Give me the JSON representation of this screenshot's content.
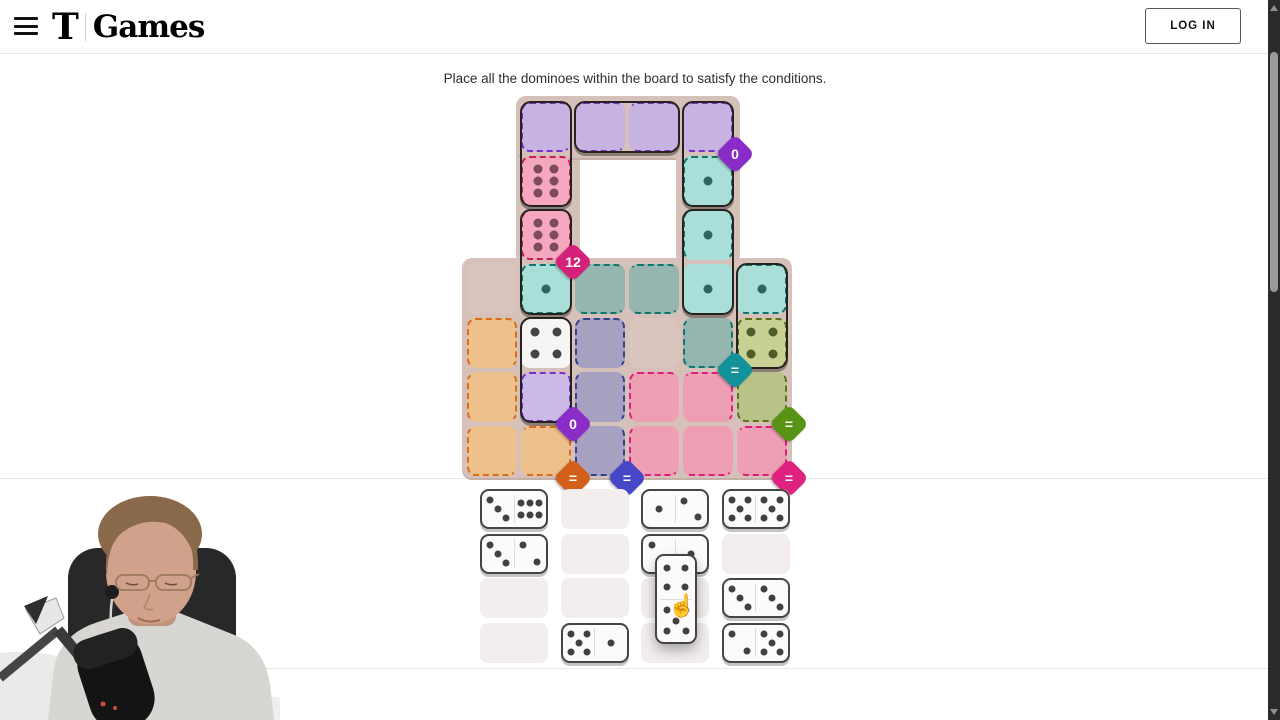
{
  "header": {
    "logo_t": "T",
    "logo_text": "Games",
    "login_label": "LOG IN"
  },
  "instruction": "Place all the dominoes within the board to satisfy the conditions.",
  "board": {
    "origin_x": 465,
    "origin_y": 100,
    "cell": 54,
    "plates": [
      {
        "x": 516,
        "y": 96,
        "w": 64,
        "h": 166
      },
      {
        "x": 516,
        "y": 96,
        "w": 224,
        "h": 62
      },
      {
        "x": 676,
        "y": 96,
        "w": 64,
        "h": 166
      },
      {
        "x": 462,
        "y": 258,
        "w": 330,
        "h": 220
      }
    ],
    "regions": {
      "purple": {
        "fill": "#c6b3e1",
        "empty": "#c6b3e1",
        "dash": "#7b2fc1",
        "pip": "#584a72"
      },
      "pink12": {
        "fill": "#f4a7bd",
        "empty": "#f4a7bd",
        "dash": "#c21f5e",
        "pip": "#7c4a61"
      },
      "teal": {
        "fill": "#a9ded9",
        "empty": "#95b6af",
        "dash": "#11756c",
        "pip": "#2f645f"
      },
      "olive": {
        "fill": "#c8d093",
        "empty": "#b8c388",
        "dash": "#5e7020",
        "pip": "#4e5c29"
      },
      "orange": {
        "fill": "#edc08c",
        "empty": "#edc08c",
        "dash": "#da6d18",
        "pip": "#8a5a20"
      },
      "slate": {
        "fill": "#a7a1c1",
        "empty": "#a7a1c1",
        "dash": "#33418f",
        "pip": "#3a3a5a"
      },
      "pinkB": {
        "fill": "#ef9fb3",
        "empty": "#ef9fb3",
        "dash": "#e11d7b",
        "pip": "#8a3a58"
      },
      "lavender": {
        "fill": "#cbb9e7",
        "empty": "#cbb9e7",
        "dash": "#7b2fc1",
        "pip": "#584a72"
      },
      "neutral": {
        "fill": "#d9c5bd",
        "empty": "#d9c5bd",
        "dash": null,
        "pip": "#444444"
      },
      "plain": {
        "fill": "#f7f5f4",
        "empty": "#f7f5f4",
        "dash": null,
        "pip": "#454545"
      }
    },
    "cells": [
      [
        0,
        1,
        "purple",
        0
      ],
      [
        0,
        2,
        "purple",
        0
      ],
      [
        0,
        3,
        "purple",
        0
      ],
      [
        0,
        4,
        "purple",
        0
      ],
      [
        1,
        1,
        "pink12",
        6
      ],
      [
        1,
        4,
        "teal",
        1
      ],
      [
        2,
        1,
        "pink12",
        6
      ],
      [
        2,
        4,
        "teal",
        1
      ],
      [
        3,
        0,
        "neutral",
        null
      ],
      [
        3,
        1,
        "teal",
        1
      ],
      [
        3,
        2,
        "teal",
        null
      ],
      [
        3,
        3,
        "teal",
        null
      ],
      [
        3,
        4,
        "teal",
        1
      ],
      [
        3,
        5,
        "teal",
        1
      ],
      [
        4,
        0,
        "orange",
        null
      ],
      [
        4,
        1,
        "plain",
        4
      ],
      [
        4,
        2,
        "slate",
        null
      ],
      [
        4,
        3,
        "neutral",
        null
      ],
      [
        4,
        4,
        "teal",
        null
      ],
      [
        4,
        5,
        "olive",
        4
      ],
      [
        5,
        0,
        "orange",
        null
      ],
      [
        5,
        1,
        "lavender",
        0
      ],
      [
        5,
        2,
        "slate",
        null
      ],
      [
        5,
        3,
        "pinkB",
        null
      ],
      [
        5,
        4,
        "pinkB",
        null
      ],
      [
        5,
        5,
        "olive",
        null
      ],
      [
        6,
        0,
        "orange",
        null
      ],
      [
        6,
        1,
        "orange",
        null
      ],
      [
        6,
        2,
        "slate",
        null
      ],
      [
        6,
        3,
        "pinkB",
        null
      ],
      [
        6,
        4,
        "pinkB",
        null
      ],
      [
        6,
        5,
        "pinkB",
        null
      ]
    ],
    "dominoes": [
      [
        0,
        1,
        1,
        1
      ],
      [
        0,
        2,
        0,
        3
      ],
      [
        0,
        4,
        1,
        4
      ],
      [
        2,
        1,
        3,
        1
      ],
      [
        2,
        4,
        3,
        4
      ],
      [
        3,
        5,
        4,
        5
      ],
      [
        4,
        1,
        5,
        1
      ]
    ],
    "badges": [
      {
        "label": "0",
        "color": "#8a2dc8",
        "col": 5,
        "row": 1
      },
      {
        "label": "12",
        "color": "#d4217a",
        "col": 2,
        "row": 3
      },
      {
        "label": "=",
        "color": "#13929b",
        "col": 5,
        "row": 5
      },
      {
        "label": "=",
        "color": "#579413",
        "col": 6,
        "row": 6
      },
      {
        "label": "0",
        "color": "#8a2dc8",
        "col": 2,
        "row": 6
      },
      {
        "label": "=",
        "color": "#d2601b",
        "col": 2,
        "row": 7
      },
      {
        "label": "=",
        "color": "#4547c6",
        "col": 3,
        "row": 7
      },
      {
        "label": "=",
        "color": "#df2280",
        "col": 6,
        "row": 7
      }
    ]
  },
  "tray": {
    "x0": 480,
    "y0": 489,
    "dx": 80.5,
    "dy": 44.5,
    "slot_w": 68,
    "slot_h": 40,
    "pip_color": "#414141",
    "slots": [
      [
        3,
        6
      ],
      null,
      [
        1,
        2
      ],
      [
        5,
        5
      ],
      [
        3,
        2
      ],
      null,
      [
        2,
        1
      ],
      null,
      null,
      null,
      null,
      [
        3,
        3
      ],
      null,
      [
        5,
        1
      ],
      null,
      [
        2,
        5
      ]
    ]
  },
  "dragged": {
    "pips": [
      4,
      5
    ],
    "x": 655,
    "y": 554,
    "w": 42,
    "h": 90,
    "cursor_x": 668,
    "cursor_y": 593
  },
  "scrollbar": {
    "thumb_y": 52,
    "thumb_h": 240
  }
}
